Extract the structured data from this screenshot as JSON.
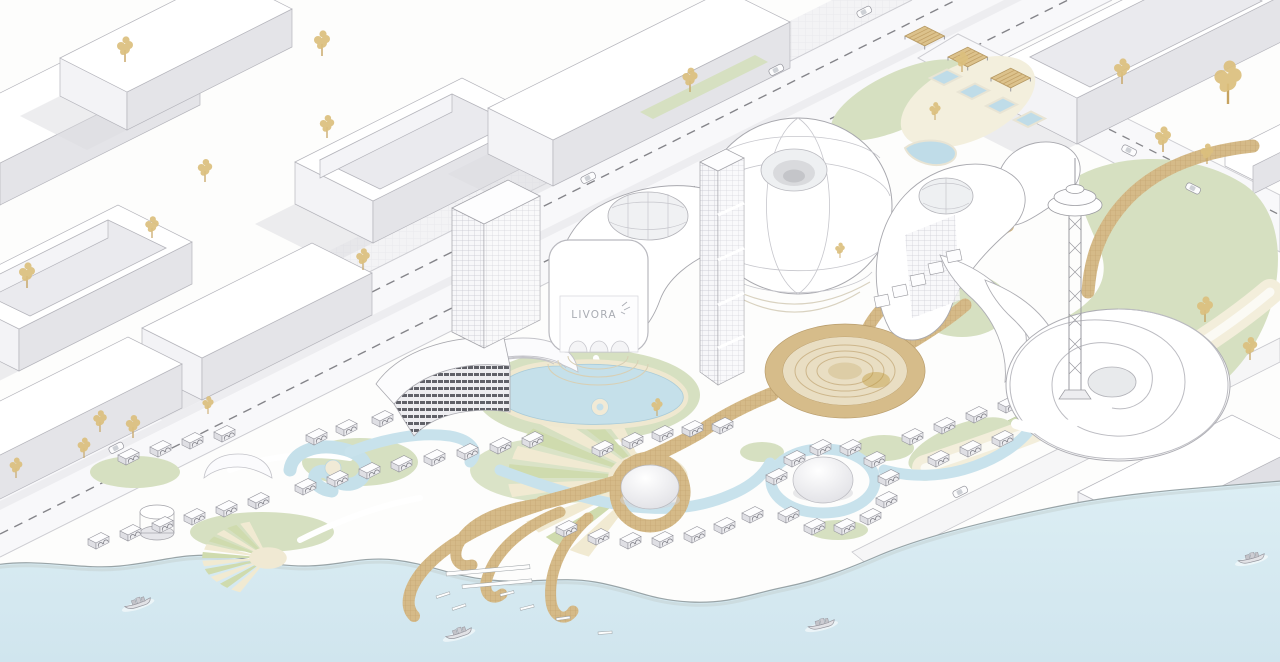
{
  "scene": {
    "type": "isometric-architectural-masterplan-rendering",
    "sign": {
      "text": "LIVORA"
    },
    "palette": {
      "land": "#fdfdfc",
      "sea": "#d6eaf1",
      "building_white": "#ffffff",
      "building_shade": "#e6e6ea",
      "outline": "#a2a2a8",
      "tree_gold": "#dcc07e",
      "lawn_green": "#d6e0c1",
      "boardwalk_tan": "#d5ba88",
      "pool_blue": "#c5e0ea",
      "plaza_cream": "#f1ead2",
      "amphitheater_beige": "#e9dec3",
      "road_line": "#85858a"
    },
    "counts": {
      "boats": 4,
      "cars": 7,
      "pergola_canopies": 3,
      "beach_villas": 52
    },
    "features": [
      "city-blocks",
      "gold-trees",
      "boulevard",
      "branch-road",
      "crosswalk",
      "parking-pergolas",
      "corner-pools",
      "torus-pavilion",
      "teardrop-podium",
      "oculus-skylight",
      "office-tower",
      "slender-tower",
      "livora-gate",
      "louver-building",
      "teardrop-tower",
      "wave-pavilions",
      "spiral-building",
      "observation-tower",
      "amphitheater",
      "lagoon-pools",
      "swirl-pool",
      "beach-villas",
      "dome-pavilions",
      "sunburst-plazas",
      "branching-pier",
      "jetties",
      "beach",
      "sea",
      "boats"
    ]
  }
}
